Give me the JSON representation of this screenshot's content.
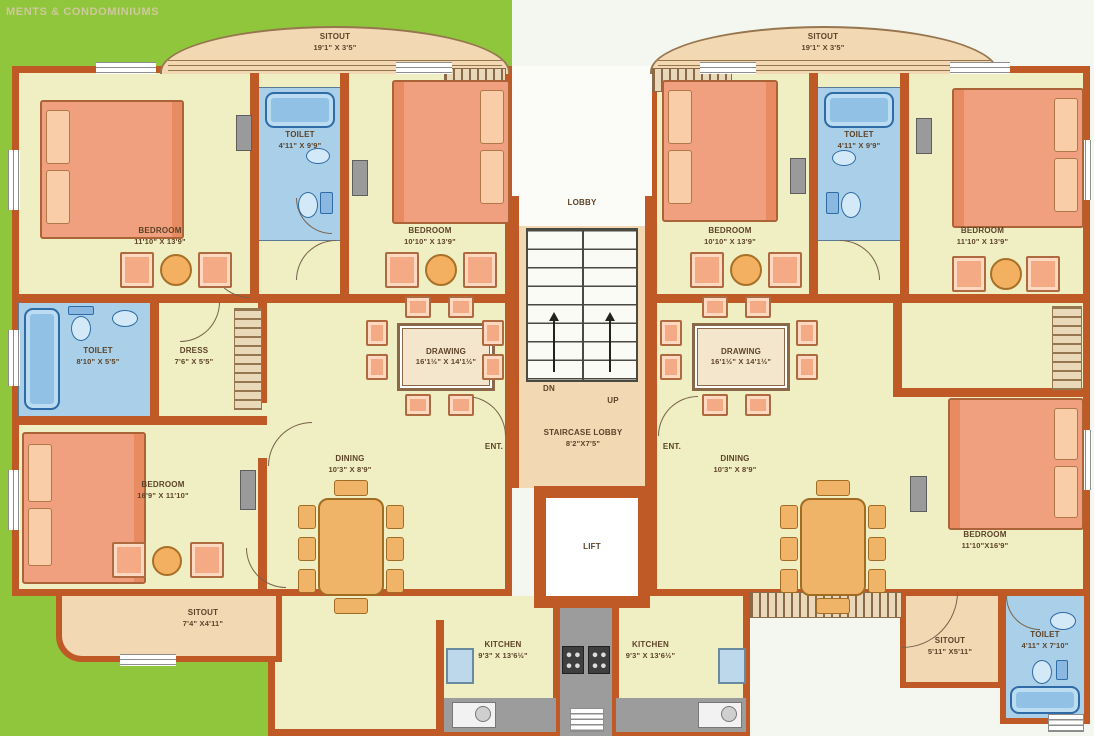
{
  "header": {
    "title": "MENTS & CONDOMINIUMS"
  },
  "colors": {
    "grass": "#90c63c",
    "wall": "#bf5a26",
    "floor": "#f0eec3",
    "sitout_peach": "#f3d8b4",
    "toilet_blue": "#a9cfe9",
    "furniture_salmon": "#f2a47e",
    "dining_wood": "#eeb262",
    "label_brown": "#5d4328"
  },
  "core": {
    "lobby": "LOBBY",
    "dn": "DN",
    "up": "UP",
    "staircase_lobby": {
      "label": "STAIRCASE LOBBY",
      "dim": "8'2\"X7'5\""
    },
    "lift": "LIFT",
    "ent_left": "ENT.",
    "ent_right": "ENT."
  },
  "rooms": {
    "l_sitout_top": {
      "label": "SITOUT",
      "dim": "19'1\" X 3'5\""
    },
    "l_bedroom1": {
      "label": "BEDROOM",
      "dim": "11'10\" X 13'9\""
    },
    "l_toilet_top": {
      "label": "TOILET",
      "dim": "4'11\" X 9'9\""
    },
    "l_bedroom2": {
      "label": "BEDROOM",
      "dim": "10'10\" X 13'9\""
    },
    "l_toilet_mid": {
      "label": "TOILET",
      "dim": "8'10\" X 5'5\""
    },
    "l_dress": {
      "label": "DRESS",
      "dim": "7'6\" X 5'5\""
    },
    "l_bedroom3": {
      "label": "BEDROOM",
      "dim": "16'9\" X 11'10\""
    },
    "l_drawing": {
      "label": "DRAWING",
      "dim": "16'1½\" X 14'1½\""
    },
    "l_dining": {
      "label": "DINING",
      "dim": "10'3\" X 8'9\""
    },
    "l_sitout_bottom": {
      "label": "SITOUT",
      "dim": "7'4\" X4'11\""
    },
    "l_kitchen": {
      "label": "KITCHEN",
      "dim": "9'3\" X 13'6½\""
    },
    "r_sitout_top": {
      "label": "SITOUT",
      "dim": "19'1\" X 3'5\""
    },
    "r_toilet_top": {
      "label": "TOILET",
      "dim": "4'11\" X 9'9\""
    },
    "r_bedroom_mid": {
      "label": "BEDROOM",
      "dim": "10'10\" X 13'9\""
    },
    "r_bedroom_top": {
      "label": "BEDROOM",
      "dim": "11'10\" X 13'9\""
    },
    "r_drawing": {
      "label": "DRAWING",
      "dim": "16'1½\" X 14'1½\""
    },
    "r_dining": {
      "label": "DINING",
      "dim": "10'3\" X 8'9\""
    },
    "r_kitchen": {
      "label": "KITCHEN",
      "dim": "9'3\" X 13'6½\""
    },
    "r_bedroom_bottom": {
      "label": "BEDROOM",
      "dim": "11'10\"X16'9\""
    },
    "r_sitout_bottom": {
      "label": "SITOUT",
      "dim": "5'11\" X5'11\""
    },
    "r_toilet_bottom": {
      "label": "TOILET",
      "dim": "4'11\" X 7'10\""
    }
  }
}
